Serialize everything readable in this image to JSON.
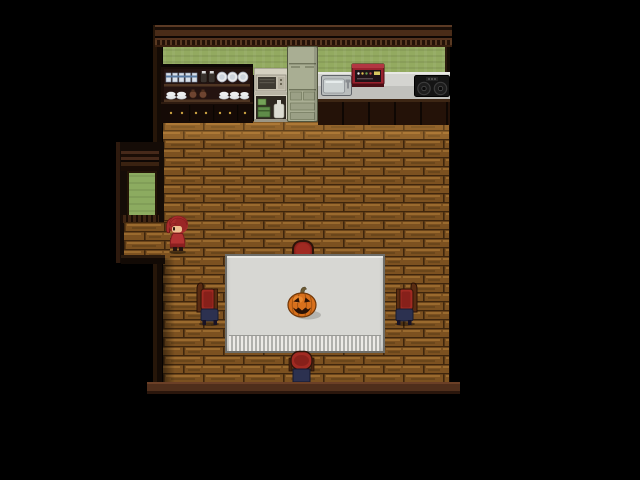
{
  "scene": {
    "type": "game-screenshot",
    "style": "top-down 2D RPG interior (pixel art)",
    "room": "kitchen and dining room",
    "description": "A dark-walled room with brown brick floor. Along the top wall: a dark hutch full of dishes, a microwave cart, a refrigerator, a sink counter with a red appliance, and a black stove top against a green wall. Center: a dining table with a white fringed tablecloth and a jack-o'-lantern, surrounded by four red-cushioned chairs. A girl with red hair stands near a western alcove doorway that opens onto grass."
  },
  "palette": {
    "background": "#000000",
    "wallGreen": "#93aa60",
    "doorGreen": "#8cab60",
    "floorBrick": "#7c5120",
    "floorMortar": "#3f260d",
    "floorHighlight": "#9a6a2e",
    "counterTop": "#d4d4d0",
    "counterFace": "#c0c0bc",
    "cabinetDark": "#241208",
    "fridgeGreen": "#a9ae93",
    "applianceRed": "#99212e",
    "stoveBlack": "#141414",
    "sinkSteel": "#ccd2d2",
    "tableCloth": "#d7d7d3",
    "fringeGray": "#b0b0ac",
    "chairRed": "#a12a22",
    "chairNavy": "#2c3150",
    "pumpkinOrange": "#d8701c",
    "hairRed": "#a62c2c",
    "dressRed": "#b23232",
    "skinTone": "#eec092",
    "baseboardBrown": "#4f2e1b"
  },
  "entities": {
    "roomTrimTop": {
      "label": "top wall crown trim",
      "rect": [
        155,
        25,
        297,
        22
      ]
    },
    "wallGreen": {
      "label": "green kitchen wallpaper",
      "rect": [
        163,
        47,
        282,
        28
      ]
    },
    "leftWall": {
      "label": "left interior wall",
      "rect": [
        153,
        25,
        12,
        358
      ]
    },
    "rightWall": {
      "label": "right interior wall",
      "rect": [
        444,
        25,
        8,
        358
      ]
    },
    "floorMain": {
      "label": "brown brick wood floor",
      "rect": [
        163,
        121,
        286,
        262
      ]
    },
    "floorLight": {
      "label": "lighter floor strip near counters",
      "rect": [
        163,
        121,
        286,
        18
      ]
    },
    "floorShadow": {
      "label": "wall shadow on floor",
      "rect": [
        163,
        258,
        12,
        125
      ]
    },
    "alcoveWall": {
      "label": "west alcove walls",
      "rect": [
        116,
        142,
        48,
        121
      ]
    },
    "alcoveTrim": {
      "label": "alcove upper trim",
      "rect": [
        121,
        151,
        38,
        20
      ]
    },
    "alcoveDoor": {
      "label": "open doorway showing grass outside",
      "rect": [
        127,
        171,
        26,
        46
      ]
    },
    "alcoveTrimB": {
      "label": "alcove door sill",
      "rect": [
        121,
        215,
        38,
        8
      ]
    },
    "alcoveFloor": {
      "label": "alcove brick floor",
      "rect": [
        124,
        222,
        46,
        36
      ]
    },
    "alcoveEdge": {
      "label": "alcove lower wall edge",
      "rect": [
        121,
        255,
        44,
        9
      ]
    },
    "hutch": {
      "label": "dark wood hutch with cups, jars, plates and bowls",
      "rect": [
        161,
        64,
        92,
        59
      ]
    },
    "microwaveCart": {
      "label": "microwave on cart with shelf goods",
      "rect": [
        254,
        68,
        34,
        54
      ]
    },
    "fridge": {
      "label": "sage-green refrigerator",
      "rect": [
        287,
        46,
        31,
        76
      ]
    },
    "counter": {
      "label": "white kitchen counter",
      "rect": [
        318,
        72,
        132,
        31
      ]
    },
    "sink": {
      "label": "steel kitchen sink with faucet",
      "rect": [
        321,
        75,
        31,
        21
      ]
    },
    "redAppliance": {
      "label": "red countertop appliance",
      "rect": [
        351,
        61,
        34,
        26
      ]
    },
    "stove": {
      "label": "black two-burner stove top",
      "rect": [
        414,
        75,
        36,
        22
      ]
    },
    "lowerCabinets": {
      "label": "dark under-counter cabinets",
      "rect": [
        318,
        99,
        132,
        26
      ]
    },
    "chairTop": {
      "label": "chair behind table (north)",
      "rect": [
        292,
        240,
        22,
        16
      ]
    },
    "table": {
      "label": "dining table with white fringed tablecloth",
      "rect": [
        225,
        254,
        160,
        99
      ]
    },
    "pumpkin": {
      "label": "jack-o'-lantern pumpkin on table",
      "rect": [
        285,
        286,
        38,
        36
      ]
    },
    "chairLeft": {
      "label": "red cushioned chair (west)",
      "rect": [
        193,
        281,
        31,
        45
      ]
    },
    "chairRight": {
      "label": "red cushioned chair (east)",
      "rect": [
        390,
        281,
        31,
        45
      ]
    },
    "chairBottom": {
      "label": "red cushioned chair (south)",
      "rect": [
        288,
        350,
        27,
        37
      ]
    },
    "character": {
      "label": "girl with red ponytail hair in red dress",
      "rect": [
        164,
        215,
        27,
        39
      ]
    },
    "baseboard": {
      "label": "bottom wall baseboard",
      "rect": [
        147,
        382,
        313,
        12
      ]
    }
  }
}
